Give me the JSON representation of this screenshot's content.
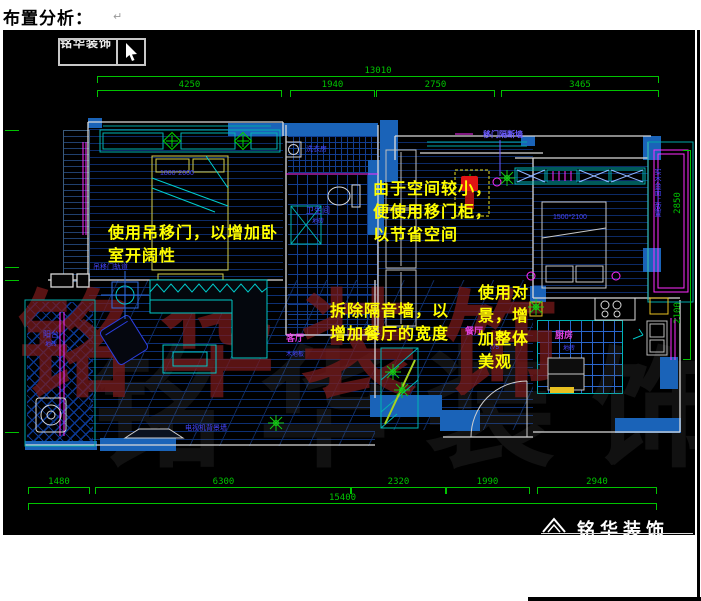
{
  "document": {
    "title": "布置分析：",
    "paragraph_mark": "↵"
  },
  "cad": {
    "viewer_box_label": "铭华装饰",
    "watermark": "铭华装饰",
    "brand_footer": "铭华装饰",
    "dims": {
      "top": {
        "total": "13010",
        "segments": [
          "4250",
          "1940",
          "2750",
          "3465"
        ]
      },
      "bottom": {
        "total": "15400",
        "segments": [
          "1480",
          "6300",
          "2320",
          "1990",
          "2940"
        ]
      },
      "right": [
        "2850",
        "2100"
      ]
    },
    "annotations": {
      "a1": {
        "l1": "使用吊移门，以增加卧",
        "l2": "室开阔性"
      },
      "a2": {
        "l1": "由于空间较小，",
        "l2": "便使用移门柜，",
        "l3": "以节省空间"
      },
      "a3": {
        "l1": "拆除隔音墙，以",
        "l2": "增加餐厅的宽度"
      },
      "a4": {
        "l1": "使用对",
        "l2": "景，增",
        "l3": "加整体",
        "l4": "美观"
      }
    },
    "labels": {
      "living": "客厅",
      "living_sub": "木地板",
      "dining": "餐厅",
      "kitchen": "厨房",
      "kitchen_sub": "地砖",
      "bath": "卫生间",
      "bath_sub": "地砖",
      "laundry": "洗衣房",
      "balcony": "阳台",
      "balcony_sub": "地砖",
      "partition": "移门隔断墙",
      "tv_wall": "电视机背景墙",
      "slide_track": "吊移门轨道",
      "balcony_right": "实木台面上放置",
      "bed1_size": "1800*2000",
      "bed2_size": "1500*2100",
      "num775": "775"
    }
  },
  "colors": {
    "dim": "#00c400",
    "yellow": "#ffff00",
    "wallblue": "#1a63b8",
    "cyan": "#00b4b4",
    "magenta": "#e040e0",
    "bluelabel": "#4646ff",
    "watermark_red": "#7c1a1a",
    "marker_red": "#e01414",
    "white_line": "#d9d9d9"
  }
}
